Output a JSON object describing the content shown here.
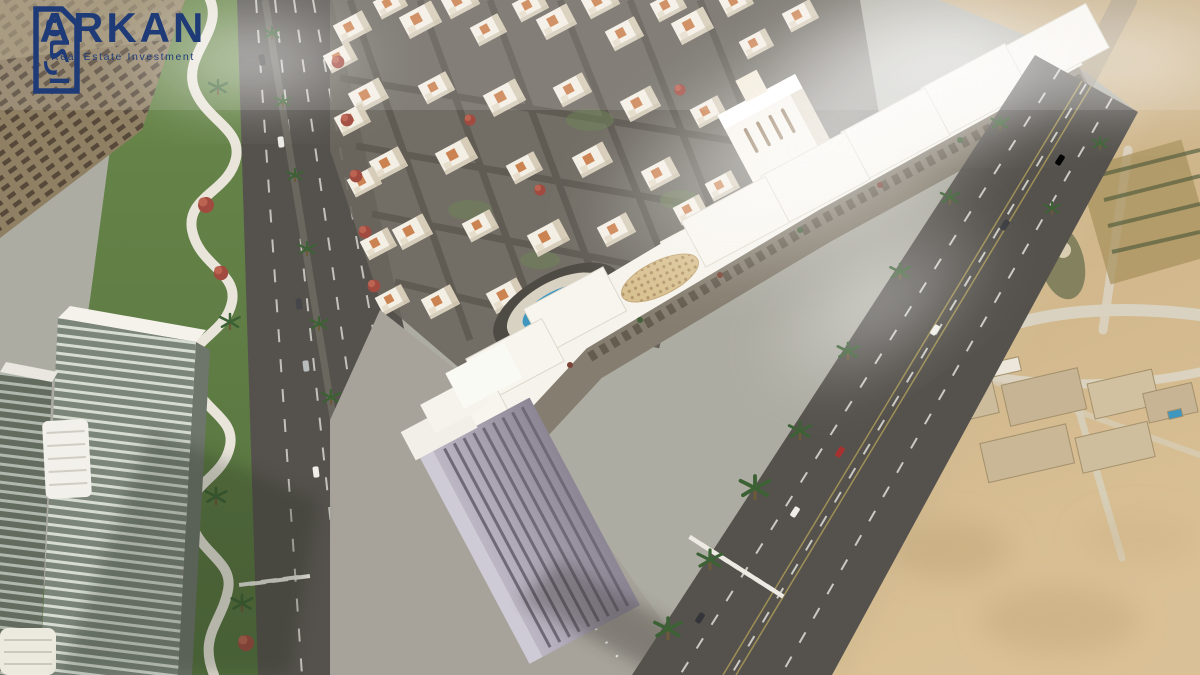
{
  "brand": {
    "name": "ARKAN",
    "tagline": "Real Estate Investment",
    "mark_text": "اركان",
    "color": "#1e3b78"
  },
  "scene": {
    "colors": {
      "sand": "#cbb286",
      "road": "#55524d",
      "lawn": "#5f7c45",
      "walkway": "#e9e5da",
      "building": "#f4efe5",
      "building_roof": "#cc8352",
      "pool": "#3f97c0",
      "mall_roof": "#f6f3ec",
      "terrace": "#857d6f",
      "office": "#968f9e",
      "plaza": "#a7a39a",
      "glass_tower": "#7c857a"
    }
  }
}
